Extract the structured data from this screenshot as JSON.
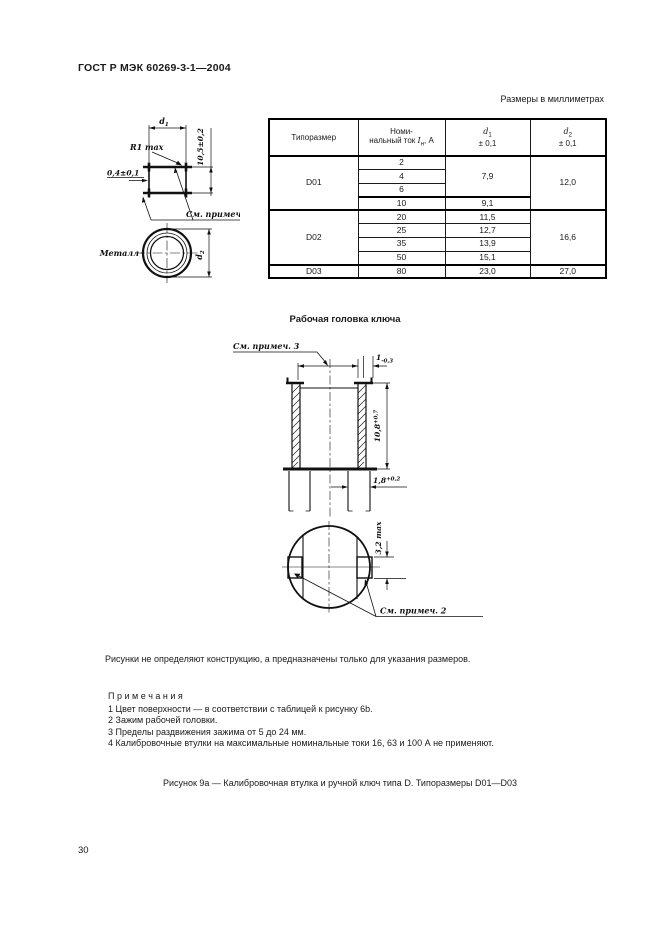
{
  "page": {
    "header_title": "ГОСТ Р МЭК 60269-3-1—2004",
    "units_note": "Размеры в миллиметрах",
    "figure_caption": "Рисунок 9а — Калибровочная втулка и ручной ключ типа D. Типоразмеры D01—D03",
    "page_number": "30"
  },
  "table": {
    "col_size": "Типоразмер",
    "col_current_line1": "Номи-",
    "col_current_pre": "нальный ток ",
    "col_current_sym": "I",
    "col_current_sub": "н",
    "col_current_post": ", А",
    "col_d1_sym": "d",
    "col_d1_sub": "1",
    "col_d1_tol": "± 0,1",
    "col_d2_sym": "d",
    "col_d2_sub": "2",
    "col_d2_tol": "± 0,1",
    "rows": [
      {
        "size": "D01",
        "current": "2",
        "d1": "7,9",
        "d2": "12,0"
      },
      {
        "current": "4"
      },
      {
        "current": "6"
      },
      {
        "current": "10",
        "d1": "9,1"
      },
      {
        "size": "D02",
        "current": "20",
        "d1": "11,5",
        "d2": "16,6"
      },
      {
        "current": "25",
        "d1": "12,7"
      },
      {
        "current": "35",
        "d1": "13,9"
      },
      {
        "current": "50",
        "d1": "15,1"
      },
      {
        "size": "D03",
        "current": "80",
        "d1": "23,0",
        "d2": "27,0"
      }
    ]
  },
  "sleeve_drawing": {
    "d1_sym": "d",
    "d1_sub": "1",
    "height_dim": "10,5±0,2",
    "radius_label": "R1 max",
    "wall_dim": "0,4±0,1",
    "note1_ref": "См. примеч. 1",
    "metal_label": "Металл",
    "d2_sym": "d",
    "d2_sub": "2"
  },
  "head_drawing": {
    "title": "Рабочая головка ключа",
    "note3_ref": "См. примеч. 3",
    "top_dim_base": "1",
    "top_dim_tol": "-0,3",
    "height_dim_base": "10,8",
    "height_dim_tol": "+0,7",
    "wall_dim_base": "1,8",
    "wall_dim_tol": "+0,2",
    "jaw_dim": "3,2 max",
    "note2_ref": "См. примеч. 2"
  },
  "notes": {
    "disclaimer": "Рисунки не определяют конструкцию, а предназначены только для указания размеров.",
    "heading": "П р и м е ч а н и я",
    "items": [
      "1  Цвет поверхности — в соответствии с таблицей к рисунку 6b.",
      "2  Зажим рабочей головки.",
      "3  Пределы раздвижения зажима от 5 до 24 мм.",
      "4  Калибровочные втулки на максимальные номинальные токи 16, 63 и 100 А не применяют."
    ]
  }
}
